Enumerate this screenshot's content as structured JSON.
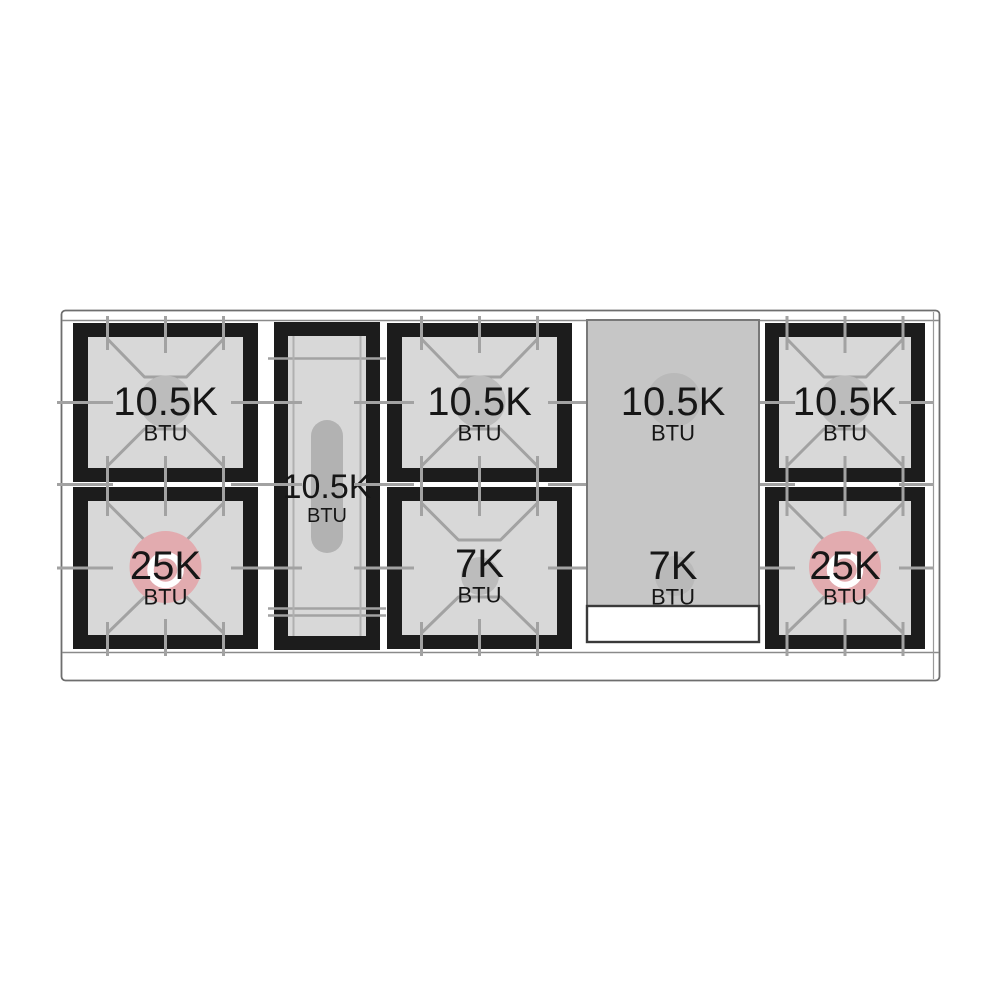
{
  "diagram": {
    "name": "Gas range cooktop burner layout with BTU ratings",
    "unit": "BTU",
    "sections": [
      {
        "id": "left-dual-burner",
        "type": "dual-burner",
        "burners": [
          {
            "position": "top",
            "value": "10.5K",
            "unit": "BTU",
            "kind": "standard"
          },
          {
            "position": "bottom",
            "value": "25K",
            "unit": "BTU",
            "kind": "power"
          }
        ]
      },
      {
        "id": "center-oval-burner",
        "type": "oval-burner",
        "burners": [
          {
            "position": "center",
            "value": "10.5K",
            "unit": "BTU",
            "kind": "oval"
          }
        ]
      },
      {
        "id": "middle-dual-burner",
        "type": "dual-burner",
        "burners": [
          {
            "position": "top",
            "value": "10.5K",
            "unit": "BTU",
            "kind": "standard"
          },
          {
            "position": "bottom",
            "value": "7K",
            "unit": "BTU",
            "kind": "simmer"
          }
        ]
      },
      {
        "id": "griddle-zone",
        "type": "griddle",
        "burners": [
          {
            "position": "top",
            "value": "10.5K",
            "unit": "BTU",
            "kind": "griddle"
          },
          {
            "position": "bottom",
            "value": "7K",
            "unit": "BTU",
            "kind": "griddle"
          }
        ]
      },
      {
        "id": "right-dual-burner",
        "type": "dual-burner",
        "burners": [
          {
            "position": "top",
            "value": "10.5K",
            "unit": "BTU",
            "kind": "standard"
          },
          {
            "position": "bottom",
            "value": "25K",
            "unit": "BTU",
            "kind": "power"
          }
        ]
      }
    ],
    "colors": {
      "frame_black": "#1c1c1c",
      "burner_surface": "#d8d8d8",
      "grate_line": "#a2a2a2",
      "burner_cap_gray": "#bcbcbc",
      "power_burner_pink": "#e2abaf",
      "power_ring_white": "#ffffff",
      "oval_capsule_gray": "#b2b2b2",
      "griddle_surface": "#c6c6c6",
      "outline_gray": "#6e6e6e"
    }
  }
}
